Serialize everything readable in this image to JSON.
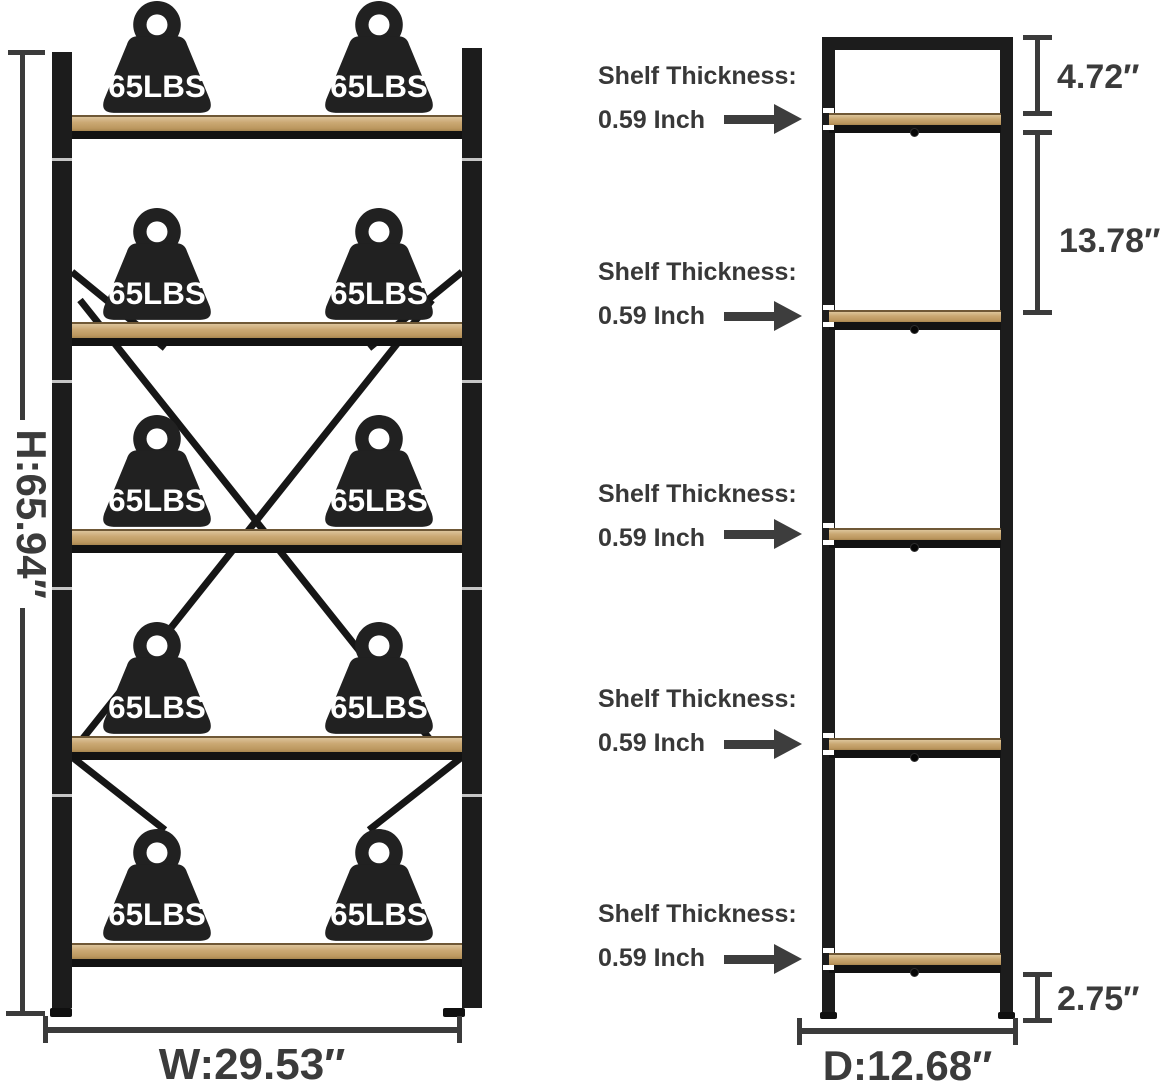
{
  "front_view": {
    "height_label": "H:65.94″",
    "width_label": "W:29.53″",
    "shelf_weight_capacity": "65LBS",
    "shelf_count": 5,
    "weights_per_shelf": 2
  },
  "side_view": {
    "depth_label": "D:12.68″",
    "top_section_height": "4.72″",
    "middle_section_height": "13.78″",
    "bottom_clearance": "2.75″"
  },
  "callout": {
    "title": "Shelf Thickness:",
    "value": "0.59 Inch",
    "count": 5
  },
  "colors": {
    "frame_black": "#1c1c1c",
    "wood_tan": "#c9a873",
    "dimension_gray": "#3b3b3b",
    "background": "#ffffff"
  }
}
